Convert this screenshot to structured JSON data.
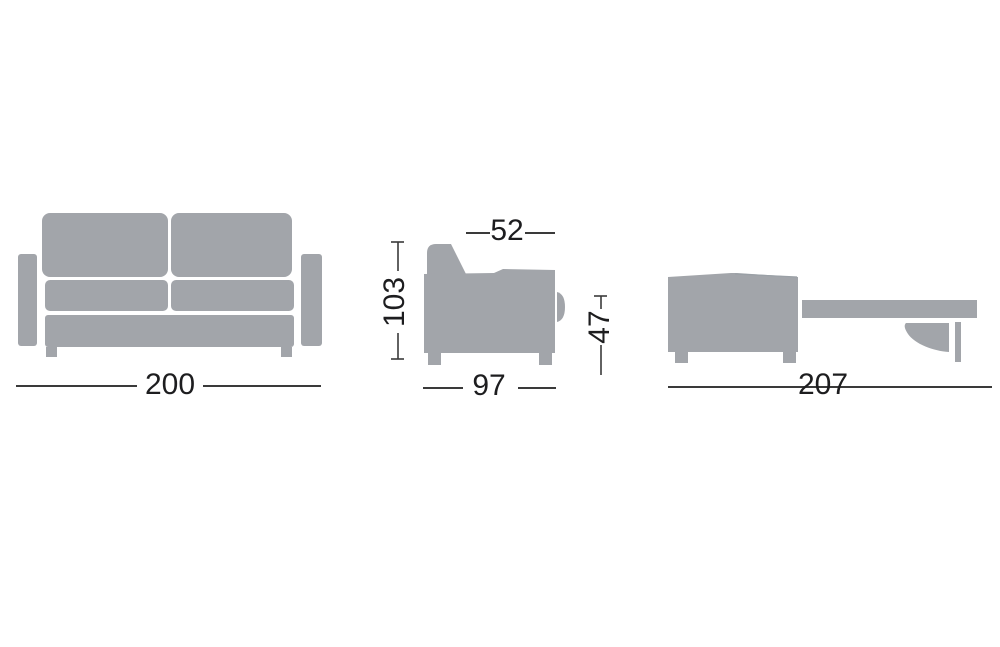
{
  "colors": {
    "background": "#ffffff",
    "body": "#a2a5aa",
    "seam": "#9aa0a6",
    "line": "#3a3a3a",
    "text": "#1d1d1f"
  },
  "labels": {
    "front_width": "200",
    "side_seat_depth": "52",
    "side_height": "103",
    "side_seat_height": "47",
    "side_depth": "97",
    "open_length": "207"
  }
}
